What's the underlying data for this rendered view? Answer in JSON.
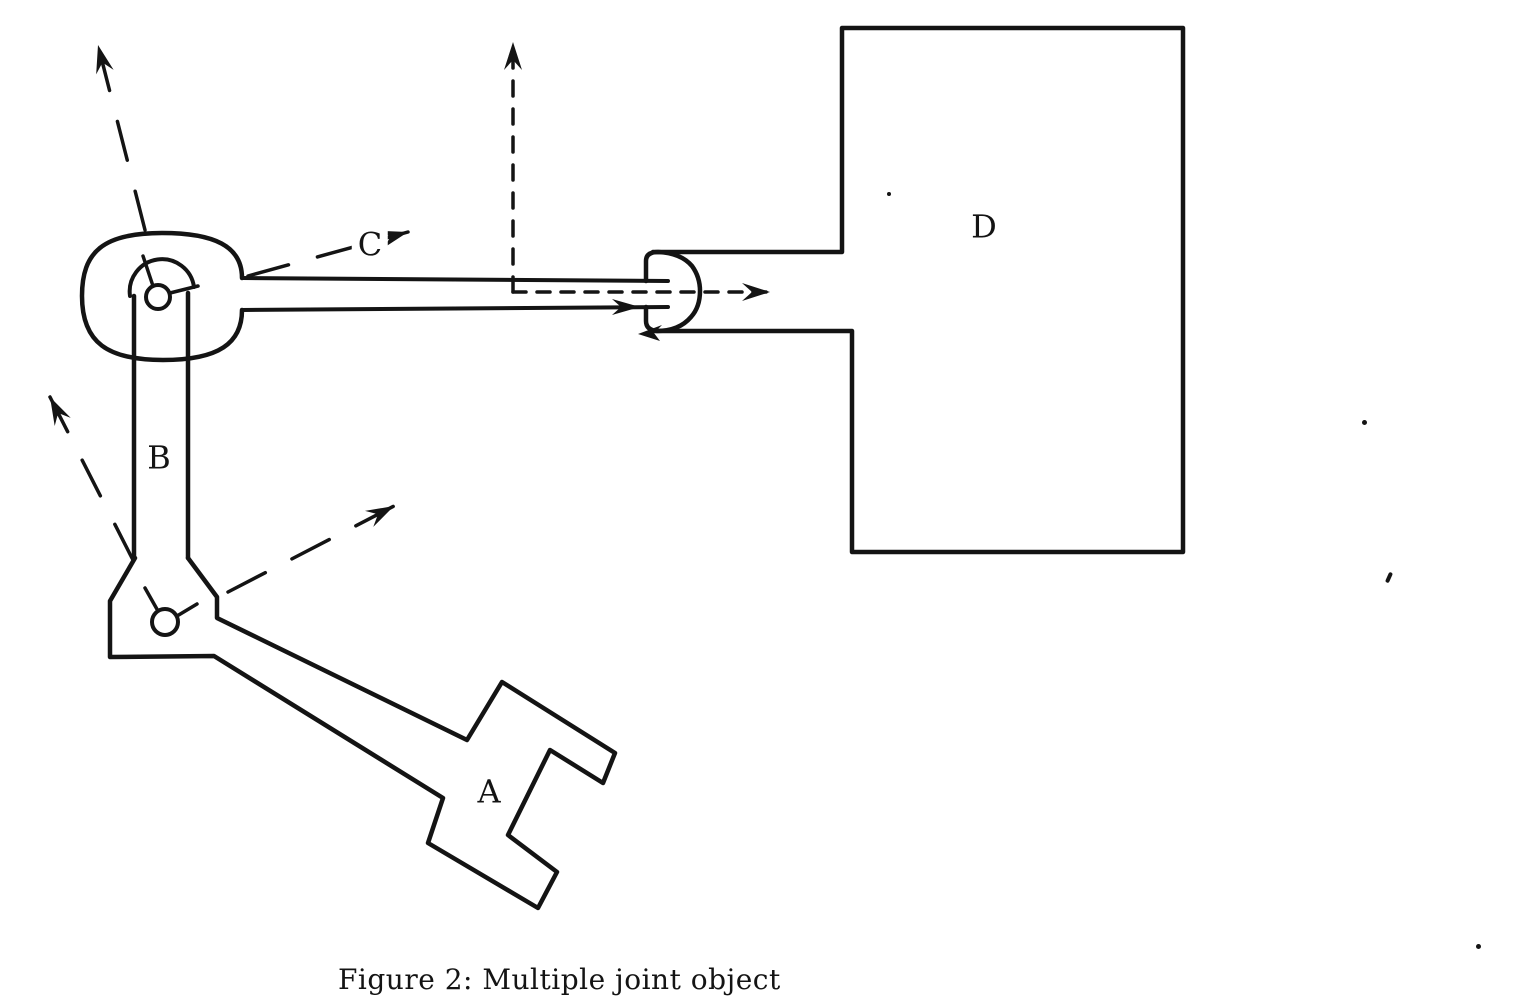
{
  "figure": {
    "kind": "scanned-line-drawing",
    "caption": "Figure 2: Multiple joint object",
    "ink_color": "#141414",
    "paper_color": "#ffffff"
  },
  "labels": {
    "a": "A",
    "b": "B",
    "c": "C",
    "d": "D"
  },
  "parts": [
    {
      "label": "A",
      "shape": "key-shaped link attached at lower pin joint"
    },
    {
      "label": "B",
      "shape": "vertical two-line link between upper and lower pin joints"
    },
    {
      "label": "C",
      "shape": "long horizontal rod ending in rounded ball inside notch of D"
    },
    {
      "label": "D",
      "shape": "large rectangle with notch on left side"
    }
  ],
  "arrows": [
    {
      "name": "upper-left-rotation-arrow",
      "style": "long-dash",
      "direction": "up-left from upper joint"
    },
    {
      "name": "label-c-rotation-arrow",
      "style": "long-dash",
      "direction": "up-right through label C"
    },
    {
      "name": "vertical-axis-arrow",
      "style": "short-dash",
      "direction": "up from rod axis corner"
    },
    {
      "name": "horizontal-axis-arrow",
      "style": "short-dash",
      "direction": "right along rod axis into D"
    },
    {
      "name": "lower-left-rotation-arrow",
      "style": "long-dash",
      "direction": "up-left from lower joint"
    },
    {
      "name": "lower-right-rotation-arrow",
      "style": "long-dash",
      "direction": "up-right from lower joint"
    },
    {
      "name": "rod-slide-arrowhead",
      "style": "solid",
      "direction": "right on lower rod edge"
    },
    {
      "name": "notch-contact-arrowhead",
      "style": "solid",
      "direction": "left at notch lower edge"
    }
  ]
}
